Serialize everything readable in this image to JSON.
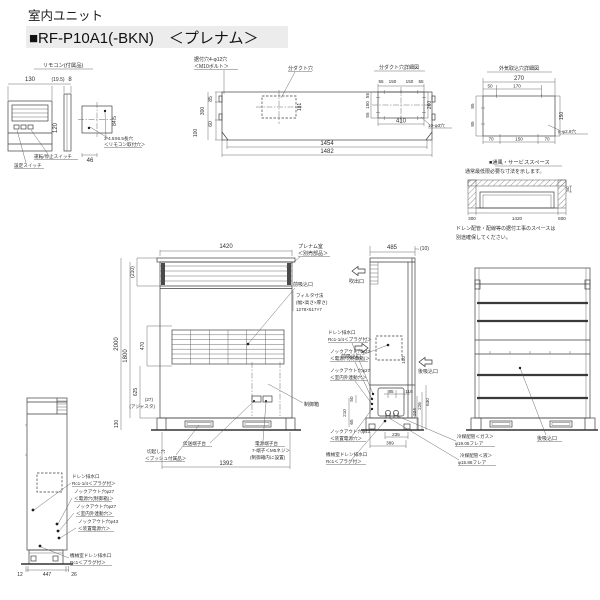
{
  "title": {
    "line1": "室内ユニット",
    "line2": "■RF-P10A1(-BKN)　＜プレナム＞"
  },
  "remote": {
    "title": "リモコン(付属品)",
    "w": "130",
    "gap": "(19.5)",
    "t": "8",
    "h": "120",
    "w2": "46",
    "h2": "84.5",
    "run_stop": "運転/停止スイッチ",
    "setting": "設定スイッチ",
    "hole1": "3-4.5X6.5長穴",
    "hole2": "＜リモコン取付穴＞"
  },
  "top_view": {
    "mount1": "据付穴4-φ12穴",
    "mount2": "＜M10ボルト＞",
    "duct": "分ダクト穴",
    "d85": "85",
    "d300": "300",
    "d60": "60",
    "d100": "100",
    "d181": "181",
    "d1454": "1454",
    "d1482": "1482"
  },
  "duct_detail": {
    "title": "分ダクト穴詳細図",
    "t1": "55",
    "t2": "150",
    "t3": "150",
    "t4": "55",
    "l1": "55",
    "l2": "150",
    "l3": "55",
    "r": "260",
    "b": "410",
    "holes": "10-φ3穴"
  },
  "intake_detail": {
    "title": "外気取込穴詳細図",
    "w": "270",
    "o1": "50",
    "o2": "170",
    "l1": "85",
    "l2": "85",
    "r": "150",
    "b1": "70",
    "b2": "150",
    "b3": "70",
    "holes": "6-φ2.9穴"
  },
  "service": {
    "title": "■通風・サービススペース",
    "sub": "通常最低限必要な寸法を示します。",
    "left": "300",
    "mid": "1420",
    "right": "600",
    "top": "50",
    "note1": "ドレン配管・配線等の据付工事のスペースは",
    "note2": "別途確保してください。"
  },
  "front": {
    "w": "1420",
    "plenum_h": "(210)",
    "h": "2000",
    "h2": "1800",
    "filter_h": "470",
    "mid_h": "625",
    "adj": "(27)",
    "adj2": "(アジャスタ)",
    "base_h": "130",
    "base_w": "1392",
    "plenum1": "プレナム室",
    "plenum2": "＜別売部品＞",
    "inlet": "前吸込口",
    "filter1": "フィルタ寸法",
    "filter2": "(幅×高さ×厚さ)",
    "filter3": "1278×517×7",
    "ctrl": "制御箱",
    "trans": "伝送端子台",
    "cut1": "切起し穴",
    "cut2": "＜ブッシュ付属品＞",
    "pwr1": "電源端子台",
    "pwr2": "7-端子＜M5ネジ＞",
    "pwr3": "(制御箱内に設置)"
  },
  "side": {
    "w": "485",
    "w2": "(10)",
    "outlet": "吹出口",
    "inlet": "前吸込口",
    "rear": "後吸込口",
    "d100": "100",
    "d85": "85",
    "d116": "116",
    "d630": "630",
    "d224": "224",
    "d226": "226",
    "d50": "50",
    "d210": "210",
    "d65": "65",
    "d235": "235",
    "d389": "389",
    "gas1": "冷媒配管＜ガス＞",
    "gas2": "φ19.05フレア",
    "liq1": "冷媒配管＜液＞",
    "liq2": "φ15.88フレア"
  },
  "ko": {
    "drain1": "ドレン排水口",
    "drain2": "Rc1-1/4＜プラグ付＞",
    "k27a1": "ノックアウト穴φ27",
    "k27a2": "＜電源穴(制御箱)＞",
    "k27b1": "ノックアウト穴φ27",
    "k27b2": "＜室内外連動穴＞",
    "k43_1": "ノックアウト穴φ43",
    "k43_2": "＜装置電源穴＞",
    "mech1": "機械室ドレン排水口",
    "mech2": "Rc1＜プラグ付＞"
  },
  "rear_view": {
    "label": "後吸込口"
  },
  "lside": {
    "d12": "12",
    "d447": "447",
    "d26": "26"
  }
}
